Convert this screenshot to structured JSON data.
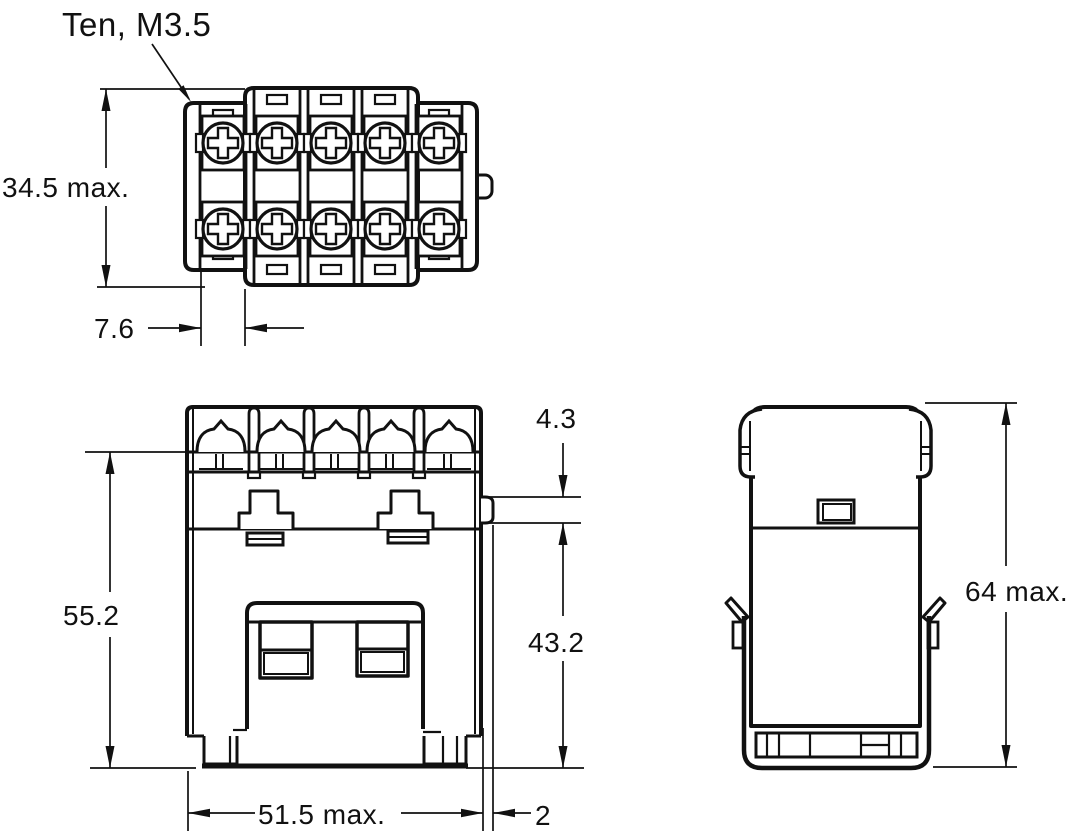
{
  "page": {
    "background": "#ffffff",
    "ink": "#111111"
  },
  "annotation": {
    "terminal_note": "Ten, M3.5"
  },
  "top_view": {
    "height_dim": "34.5 max.",
    "pitch_dim": "7.6"
  },
  "front_view": {
    "height_dim": "55.2",
    "tab_offset_dim": "4.3",
    "lower_height_dim": "43.2",
    "width_dim": "51.5 max.",
    "protrusion_dim": "2"
  },
  "side_view": {
    "height_dim": "64 max."
  }
}
